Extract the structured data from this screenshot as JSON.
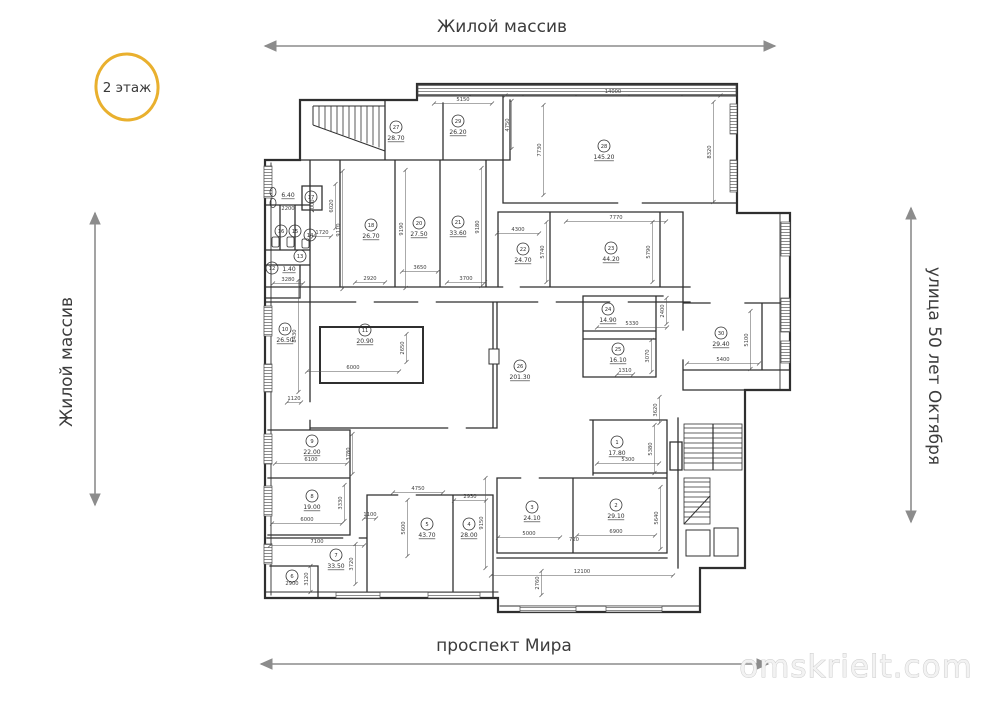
{
  "floor_badge": {
    "label": "2 этаж",
    "ring_color": "#e9b02e"
  },
  "streets": {
    "top": "Жилой массив",
    "left": "Жилой массив",
    "right": "улица 50 лет Октября",
    "bottom": "проспект Мира"
  },
  "watermark": {
    "text": "omskrielt.com"
  },
  "colors": {
    "arrow": "#8c8c8c",
    "plan_line": "#2f2f2f",
    "dim_text": "#3f3f3f"
  },
  "plan": {
    "rooms": [
      {
        "n": "1",
        "a": "17.80",
        "x": 617,
        "y": 442
      },
      {
        "n": "2",
        "a": "29.10",
        "x": 616,
        "y": 505
      },
      {
        "n": "3",
        "a": "24.10",
        "x": 532,
        "y": 507
      },
      {
        "n": "4",
        "a": "28.00",
        "x": 469,
        "y": 524
      },
      {
        "n": "5",
        "a": "43.70",
        "x": 427,
        "y": 524
      },
      {
        "n": "6",
        "a": "",
        "x": 292,
        "y": 576
      },
      {
        "n": "7",
        "a": "33.50",
        "x": 336,
        "y": 555
      },
      {
        "n": "8",
        "a": "19.00",
        "x": 312,
        "y": 496
      },
      {
        "n": "9",
        "a": "22.00",
        "x": 312,
        "y": 441
      },
      {
        "n": "10",
        "a": "26.50",
        "x": 285,
        "y": 329
      },
      {
        "n": "11",
        "a": "20.90",
        "x": 365,
        "y": 330
      },
      {
        "n": "12",
        "a": "1.40",
        "x": 272,
        "y": 268,
        "ax": 289,
        "ay": 271
      },
      {
        "n": "13",
        "a": "",
        "x": 300,
        "y": 256
      },
      {
        "n": "14",
        "a": "",
        "x": 310,
        "y": 235
      },
      {
        "n": "15",
        "a": "",
        "x": 295,
        "y": 231
      },
      {
        "n": "16",
        "a": "",
        "x": 281,
        "y": 231
      },
      {
        "n": "17",
        "a": "",
        "x": 311,
        "y": 197
      },
      {
        "n": "18",
        "a": "26.70",
        "x": 371,
        "y": 225
      },
      {
        "n": "20",
        "a": "27.50",
        "x": 419,
        "y": 223
      },
      {
        "n": "21",
        "a": "33.60",
        "x": 458,
        "y": 222
      },
      {
        "n": "22",
        "a": "24.70",
        "x": 523,
        "y": 249
      },
      {
        "n": "23",
        "a": "44.20",
        "x": 611,
        "y": 248
      },
      {
        "n": "24",
        "a": "14.90",
        "x": 608,
        "y": 309
      },
      {
        "n": "25",
        "a": "16.10",
        "x": 618,
        "y": 349
      },
      {
        "n": "26",
        "a": "201.30",
        "x": 520,
        "y": 366
      },
      {
        "n": "27",
        "a": "28.70",
        "x": 396,
        "y": 127
      },
      {
        "n": "28",
        "a": "145.20",
        "x": 604,
        "y": 146
      },
      {
        "n": "29",
        "a": "26.20",
        "x": 458,
        "y": 121
      },
      {
        "n": "30",
        "a": "29.40",
        "x": 721,
        "y": 333
      },
      {
        "n": "",
        "a": "6.40",
        "x": 288,
        "y": 190,
        "ax": 288,
        "ay": 197
      }
    ],
    "dims": [
      {
        "t": "5150",
        "x": 463,
        "y": 101,
        "o": "h",
        "l": 58
      },
      {
        "t": "14000",
        "x": 613,
        "y": 93,
        "o": "h",
        "l": 215
      },
      {
        "t": "7730",
        "x": 541,
        "y": 150,
        "o": "v",
        "l": 90
      },
      {
        "t": "8320",
        "x": 711,
        "y": 152,
        "o": "v",
        "l": 100
      },
      {
        "t": "4750",
        "x": 509,
        "y": 125,
        "o": "v",
        "l": 48
      },
      {
        "t": "6020",
        "x": 333,
        "y": 206,
        "o": "v",
        "l": 44
      },
      {
        "t": "2000",
        "x": 314,
        "y": 206,
        "o": "v",
        "l": 0
      },
      {
        "t": "2200",
        "x": 288,
        "y": 210,
        "o": "h",
        "l": 0
      },
      {
        "t": "1720",
        "x": 322,
        "y": 234,
        "o": "h",
        "l": 18
      },
      {
        "t": "3280",
        "x": 288,
        "y": 281,
        "o": "h",
        "l": 30
      },
      {
        "t": "9110",
        "x": 340,
        "y": 230,
        "o": "v",
        "l": 118
      },
      {
        "t": "9190",
        "x": 403,
        "y": 229,
        "o": "v",
        "l": 118
      },
      {
        "t": "9180",
        "x": 479,
        "y": 227,
        "o": "v",
        "l": 118
      },
      {
        "t": "2920",
        "x": 370,
        "y": 280,
        "o": "h",
        "l": 30
      },
      {
        "t": "3650",
        "x": 420,
        "y": 269,
        "o": "h",
        "l": 36
      },
      {
        "t": "3700",
        "x": 466,
        "y": 280,
        "o": "h",
        "l": 38
      },
      {
        "t": "4300",
        "x": 518,
        "y": 231,
        "o": "h",
        "l": 42
      },
      {
        "t": "7770",
        "x": 616,
        "y": 219,
        "o": "h",
        "l": 100
      },
      {
        "t": "5740",
        "x": 544,
        "y": 252,
        "o": "v",
        "l": 60
      },
      {
        "t": "5790",
        "x": 650,
        "y": 252,
        "o": "v",
        "l": 60
      },
      {
        "t": "2400",
        "x": 664,
        "y": 311,
        "o": "v",
        "l": 26
      },
      {
        "t": "5330",
        "x": 632,
        "y": 325,
        "o": "h",
        "l": 70
      },
      {
        "t": "3070",
        "x": 649,
        "y": 356,
        "o": "v",
        "l": 32
      },
      {
        "t": "1310",
        "x": 625,
        "y": 372,
        "o": "h",
        "l": 16
      },
      {
        "t": "5400",
        "x": 723,
        "y": 361,
        "o": "h",
        "l": 72
      },
      {
        "t": "5100",
        "x": 748,
        "y": 340,
        "o": "v",
        "l": 58
      },
      {
        "t": "2650",
        "x": 404,
        "y": 348,
        "o": "v",
        "l": 28
      },
      {
        "t": "6000",
        "x": 353,
        "y": 369,
        "o": "h",
        "l": 92
      },
      {
        "t": "1120",
        "x": 294,
        "y": 400,
        "o": "h",
        "l": 14
      },
      {
        "t": "8430",
        "x": 296,
        "y": 336,
        "o": "v",
        "l": 112
      },
      {
        "t": "3620",
        "x": 657,
        "y": 410,
        "o": "v",
        "l": 26
      },
      {
        "t": "6100",
        "x": 311,
        "y": 461,
        "o": "h",
        "l": 72
      },
      {
        "t": "3780",
        "x": 350,
        "y": 454,
        "o": "v",
        "l": 40
      },
      {
        "t": "6000",
        "x": 307,
        "y": 521,
        "o": "h",
        "l": 70
      },
      {
        "t": "3330",
        "x": 342,
        "y": 503,
        "o": "v",
        "l": 36
      },
      {
        "t": "1100",
        "x": 370,
        "y": 516,
        "o": "h",
        "l": 12
      },
      {
        "t": "7100",
        "x": 317,
        "y": 543,
        "o": "h",
        "l": 94
      },
      {
        "t": "3720",
        "x": 353,
        "y": 564,
        "o": "v",
        "l": 40
      },
      {
        "t": "3120",
        "x": 308,
        "y": 579,
        "o": "v",
        "l": 26
      },
      {
        "t": "2900",
        "x": 292,
        "y": 585,
        "o": "h",
        "l": 0
      },
      {
        "t": "4750",
        "x": 418,
        "y": 490,
        "o": "h",
        "l": 50
      },
      {
        "t": "5600",
        "x": 405,
        "y": 528,
        "o": "v",
        "l": 56
      },
      {
        "t": "2930",
        "x": 470,
        "y": 498,
        "o": "h",
        "l": 32
      },
      {
        "t": "9150",
        "x": 483,
        "y": 523,
        "o": "v",
        "l": 90
      },
      {
        "t": "5000",
        "x": 529,
        "y": 535,
        "o": "h",
        "l": 62
      },
      {
        "t": "720",
        "x": 574,
        "y": 541,
        "o": "h",
        "l": 0
      },
      {
        "t": "6900",
        "x": 616,
        "y": 533,
        "o": "h",
        "l": 78
      },
      {
        "t": "5640",
        "x": 658,
        "y": 518,
        "o": "v",
        "l": 62
      },
      {
        "t": "5300",
        "x": 628,
        "y": 461,
        "o": "h",
        "l": 62
      },
      {
        "t": "5380",
        "x": 652,
        "y": 449,
        "o": "v",
        "l": 48
      },
      {
        "t": "12100",
        "x": 582,
        "y": 573,
        "o": "h",
        "l": 182
      },
      {
        "t": "2760",
        "x": 539,
        "y": 583,
        "o": "v",
        "l": 24
      }
    ]
  }
}
